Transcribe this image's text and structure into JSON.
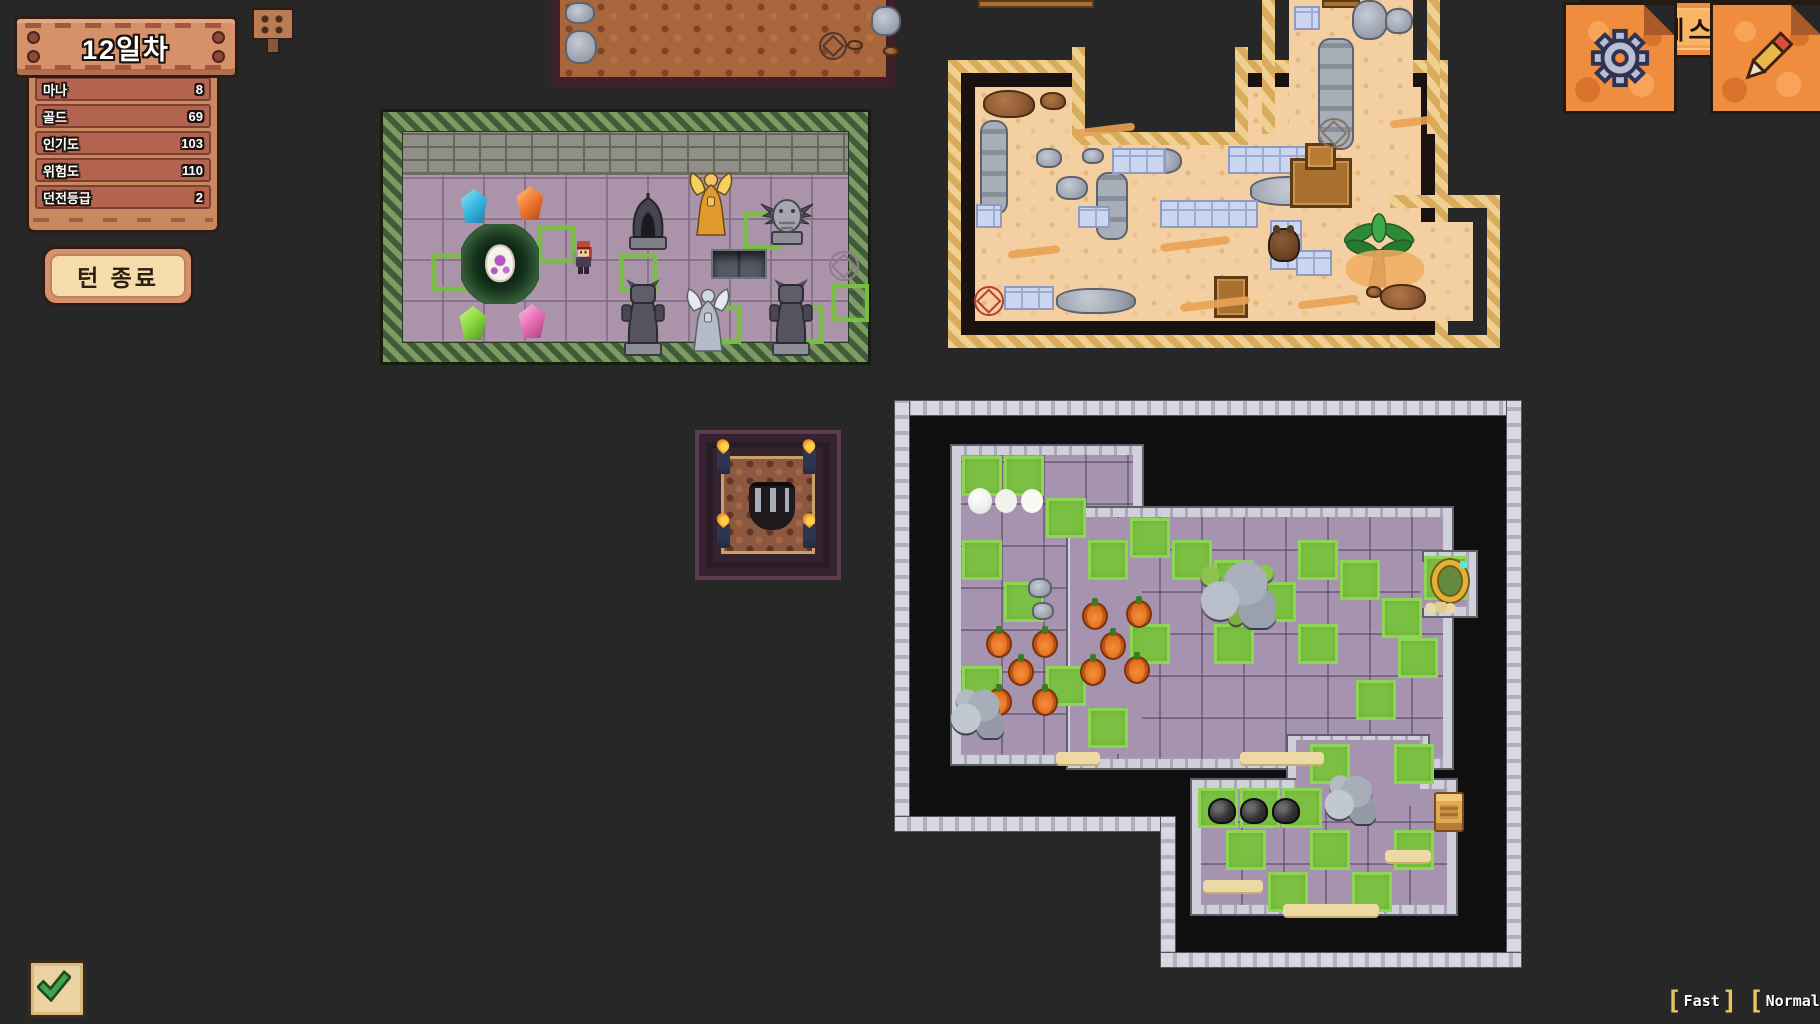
{
  "hud": {
    "day_label": "12일차",
    "stats": [
      {
        "label": "마나",
        "value": "8"
      },
      {
        "label": "골드",
        "value": "69"
      },
      {
        "label": "인기도",
        "value": "103"
      },
      {
        "label": "위험도",
        "value": "110"
      },
      {
        "label": "던전등급",
        "value": "2"
      }
    ],
    "end_turn_label": "턴 종료",
    "menu": [
      "시설 배치",
      "몬스터 소환",
      "몬스터 관리",
      "길드 방문",
      "퀘스트"
    ],
    "speed": [
      "Fast",
      "Normal"
    ],
    "icons": [
      "gear-icon",
      "pencil-icon",
      "check-icon",
      "sign-icon"
    ],
    "colors": {
      "background": "#272727",
      "wood_light": "#d6916b",
      "wood_row": "#b26450",
      "parchment_orange": "#ef8c3e",
      "parchment_light": "#fdc37e",
      "cream": "#f6dcab",
      "bracket_yellow": "#e8c55a",
      "sand": "#f3cfa1",
      "purple_tile": "#a593b0",
      "grass_green": "#7cc043",
      "vine_green": "#3e5c3a"
    }
  },
  "rooms": {
    "dirt": {
      "x": 551,
      "y": 0,
      "objects": [
        [
          "rock",
          556,
          2,
          30,
          22
        ],
        [
          "rock",
          556,
          30,
          32,
          34
        ],
        [
          "rock",
          862,
          6,
          30,
          30
        ],
        [
          "brock",
          838,
          40,
          16,
          10
        ],
        [
          "brock",
          874,
          46,
          16,
          10
        ],
        [
          "circle-dark",
          810,
          32,
          28,
          28
        ]
      ]
    },
    "nest": {
      "x": 383,
      "y": 112,
      "objects": [
        [
          "spawn",
          412,
          234,
          38,
          38
        ],
        [
          "spawn",
          519,
          206,
          38,
          38
        ],
        [
          "spawn",
          600,
          234,
          38,
          38
        ],
        [
          "spawn",
          684,
          287,
          38,
          38
        ],
        [
          "spawn",
          725,
          193,
          38,
          38
        ],
        [
          "spawn",
          767,
          287,
          38,
          38
        ],
        [
          "spawn",
          812,
          265,
          38,
          38
        ],
        [
          "crystal-blue",
          440,
          170,
          30,
          34
        ],
        [
          "crystal-orange",
          496,
          167,
          30,
          34
        ],
        [
          "crystal-green",
          439,
          287,
          30,
          34
        ],
        [
          "crystal-pink",
          498,
          285,
          30,
          34
        ],
        [
          "nest",
          442,
          205,
          78,
          80
        ],
        [
          "hero",
          552,
          220,
          26,
          36
        ],
        [
          "helm",
          606,
          172,
          46,
          60
        ],
        [
          "angel-gold",
          668,
          150,
          48,
          68
        ],
        [
          "gargoyle",
          740,
          173,
          56,
          54
        ],
        [
          "pit",
          692,
          230,
          56,
          30
        ],
        [
          "demon",
          599,
          260,
          50,
          78
        ],
        [
          "angel-white",
          665,
          262,
          48,
          76
        ],
        [
          "demon",
          747,
          260,
          50,
          78
        ],
        [
          "circle-purple",
          810,
          232,
          30,
          30
        ]
      ]
    },
    "furnace": {
      "x": 695,
      "y": 430,
      "objects": [
        [
          "torch",
          713,
          446,
          13,
          24
        ],
        [
          "torch",
          799,
          446,
          13,
          24
        ],
        [
          "torch",
          713,
          520,
          13,
          24
        ],
        [
          "torch",
          799,
          520,
          13,
          24
        ],
        [
          "cave",
          745,
          478,
          46,
          48
        ]
      ]
    },
    "desert": {
      "x": 948,
      "y": 0,
      "objects": [
        [
          "cratebar",
          978,
          0,
          116,
          8
        ],
        [
          "cratebar",
          1322,
          0,
          38,
          8
        ],
        [
          "brock",
          983,
          90,
          52,
          28
        ],
        [
          "brock",
          1040,
          92,
          26,
          18
        ],
        [
          "rocksv",
          980,
          120,
          28,
          95
        ],
        [
          "rock",
          1036,
          148,
          26,
          20
        ],
        [
          "rock",
          1082,
          148,
          22,
          16
        ],
        [
          "rock",
          1056,
          176,
          32,
          24
        ],
        [
          "rocksv",
          1096,
          172,
          32,
          68
        ],
        [
          "rock",
          1142,
          148,
          40,
          26
        ],
        [
          "rock",
          1250,
          176,
          88,
          30
        ],
        [
          "rocksv",
          1318,
          38,
          36,
          112
        ],
        [
          "rock",
          1352,
          0,
          36,
          40
        ],
        [
          "rock",
          1385,
          8,
          28,
          26
        ],
        [
          "btile",
          1112,
          148,
          54,
          26
        ],
        [
          "btile",
          1228,
          146,
          88,
          28
        ],
        [
          "btile",
          1160,
          200,
          98,
          28
        ],
        [
          "btile",
          1078,
          206,
          32,
          22
        ],
        [
          "btile",
          976,
          204,
          26,
          24
        ],
        [
          "btile",
          1004,
          286,
          50,
          24
        ],
        [
          "btile",
          1270,
          220,
          32,
          50
        ],
        [
          "btile",
          1296,
          250,
          36,
          26
        ],
        [
          "btile",
          1294,
          6,
          26,
          24
        ],
        [
          "desk",
          1290,
          158,
          62,
          50
        ],
        [
          "crate",
          1214,
          276,
          34,
          42
        ],
        [
          "monster",
          1268,
          228,
          32,
          34
        ],
        [
          "palm",
          1340,
          208,
          78,
          80
        ],
        [
          "sandpatch",
          1346,
          250,
          78,
          38
        ],
        [
          "brock",
          1380,
          284,
          46,
          26
        ],
        [
          "brock",
          1366,
          286,
          16,
          12
        ],
        [
          "circle-red",
          974,
          286,
          30,
          30
        ],
        [
          "circle-gray",
          1318,
          118,
          32,
          30
        ],
        [
          "rock",
          1056,
          288,
          80,
          26
        ],
        [
          "streak",
          1075,
          126,
          60,
          8
        ],
        [
          "streak",
          1160,
          240,
          70,
          8
        ],
        [
          "streak",
          1008,
          248,
          52,
          8
        ],
        [
          "streak",
          1298,
          298,
          60,
          8
        ],
        [
          "streak",
          1390,
          118,
          44,
          8
        ],
        [
          "streak",
          1180,
          300,
          70,
          8
        ]
      ]
    },
    "dungeon": {
      "x": 894,
      "y": 400,
      "objects": [
        [
          "green",
          962,
          456,
          40,
          40
        ],
        [
          "green",
          1004,
          456,
          40,
          40
        ],
        [
          "green",
          1046,
          498,
          40,
          40
        ],
        [
          "green",
          962,
          540,
          40,
          40
        ],
        [
          "green",
          1004,
          582,
          40,
          40
        ],
        [
          "green",
          1088,
          540,
          40,
          40
        ],
        [
          "green",
          1130,
          518,
          40,
          40
        ],
        [
          "green",
          1172,
          540,
          40,
          40
        ],
        [
          "green",
          1214,
          560,
          40,
          40
        ],
        [
          "green",
          1256,
          582,
          40,
          40
        ],
        [
          "green",
          1298,
          540,
          40,
          40
        ],
        [
          "green",
          1340,
          560,
          40,
          40
        ],
        [
          "green",
          1382,
          598,
          40,
          40
        ],
        [
          "green",
          1298,
          624,
          40,
          40
        ],
        [
          "green",
          1214,
          624,
          40,
          40
        ],
        [
          "green",
          1356,
          680,
          40,
          40
        ],
        [
          "green",
          1398,
          638,
          40,
          40
        ],
        [
          "green",
          1130,
          624,
          40,
          40
        ],
        [
          "green",
          1046,
          666,
          40,
          40
        ],
        [
          "green",
          1088,
          708,
          40,
          40
        ],
        [
          "green",
          962,
          666,
          40,
          40
        ],
        [
          "green",
          1424,
          556,
          44,
          44
        ],
        [
          "green",
          1198,
          788,
          40,
          40
        ],
        [
          "green",
          1240,
          788,
          40,
          40
        ],
        [
          "green",
          1282,
          788,
          40,
          40
        ],
        [
          "green",
          1226,
          830,
          40,
          40
        ],
        [
          "green",
          1268,
          872,
          40,
          40
        ],
        [
          "green",
          1310,
          830,
          40,
          40
        ],
        [
          "green",
          1352,
          872,
          40,
          40
        ],
        [
          "green",
          1394,
          830,
          40,
          40
        ],
        [
          "green",
          1310,
          744,
          40,
          40
        ],
        [
          "green",
          1394,
          744,
          40,
          40
        ],
        [
          "eggs3",
          968,
          488,
          24,
          26
        ],
        [
          "pumpkin",
          1082,
          602,
          26,
          28
        ],
        [
          "pumpkin",
          1126,
          600,
          26,
          28
        ],
        [
          "pumpkin",
          986,
          630,
          26,
          28
        ],
        [
          "pumpkin",
          1032,
          630,
          26,
          28
        ],
        [
          "pumpkin",
          1100,
          632,
          26,
          28
        ],
        [
          "pumpkin",
          1008,
          658,
          26,
          28
        ],
        [
          "pumpkin",
          1080,
          658,
          26,
          28
        ],
        [
          "pumpkin",
          1124,
          656,
          26,
          28
        ],
        [
          "pumpkin",
          986,
          688,
          26,
          28
        ],
        [
          "pumpkin",
          1032,
          688,
          26,
          28
        ],
        [
          "rock",
          1028,
          578,
          24,
          20
        ],
        [
          "rock",
          1032,
          602,
          22,
          18
        ],
        [
          "mossrocks",
          1196,
          556,
          80,
          72
        ],
        [
          "portal",
          1432,
          560,
          36,
          42
        ],
        [
          "pebbles",
          1424,
          602,
          32,
          12
        ],
        [
          "rockpile",
          948,
          684,
          56,
          54
        ],
        [
          "coal",
          1208,
          798,
          28,
          26
        ],
        [
          "coal",
          1240,
          798,
          28,
          26
        ],
        [
          "coal",
          1272,
          798,
          28,
          26
        ],
        [
          "rockpile",
          1322,
          770,
          54,
          54
        ],
        [
          "spool",
          1434,
          792,
          30,
          40
        ],
        [
          "sandstrip",
          1203,
          880,
          60,
          12
        ],
        [
          "sandstrip",
          1283,
          904,
          96,
          12
        ],
        [
          "sandstrip",
          1385,
          850,
          46,
          12
        ],
        [
          "sandstrip",
          1240,
          752,
          84,
          12
        ],
        [
          "sandstrip",
          1056,
          752,
          44,
          12
        ]
      ]
    }
  }
}
